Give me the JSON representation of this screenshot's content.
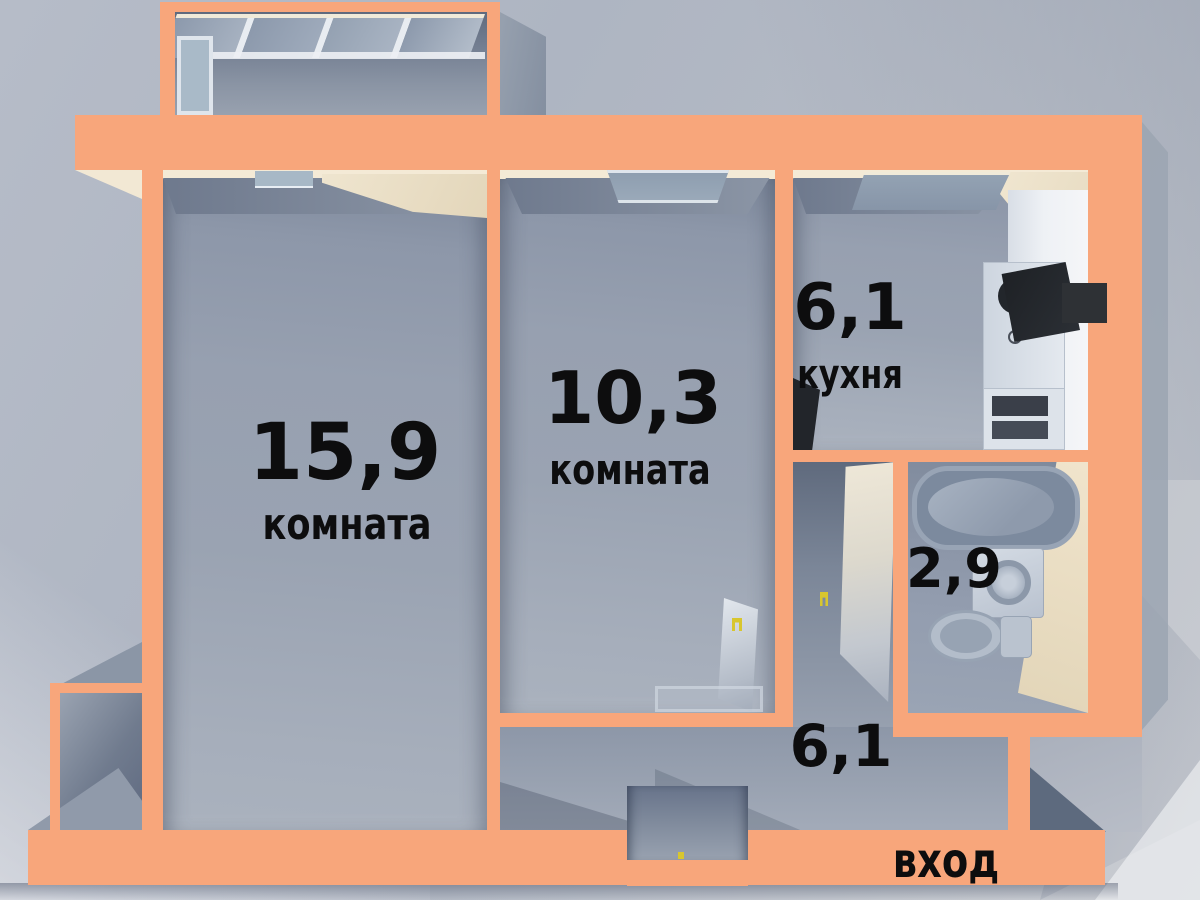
{
  "floorplan": {
    "type": "apartment-floor-plan-3d",
    "rooms": [
      {
        "key": "living-room",
        "area": "15,9",
        "name": "комната"
      },
      {
        "key": "bedroom",
        "area": "10,3",
        "name": "комната"
      },
      {
        "key": "kitchen",
        "area": "6,1",
        "name": "кухня"
      },
      {
        "key": "bathroom",
        "area": "2,9",
        "name": ""
      },
      {
        "key": "hallway",
        "area": "6,1",
        "name": ""
      }
    ],
    "entrance_label": "вход",
    "colors": {
      "wall": "#f8a67b",
      "floor": "#97a1b1",
      "bg": "#b3b9c5",
      "cream": "#f2e8d4",
      "label": "#0d0d0e"
    }
  }
}
